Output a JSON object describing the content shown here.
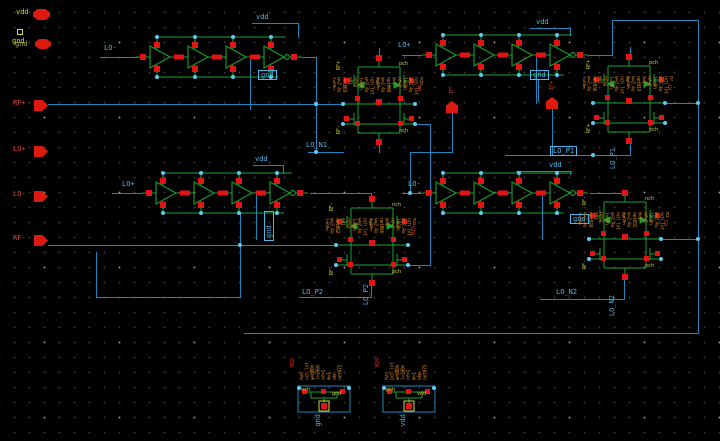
{
  "colors": {
    "wire": "#1b87bd",
    "net_label": "#4ab6e8",
    "device_green": "#17a22e",
    "terminal_red": "#e31414",
    "junction_cyan": "#5fc9f2",
    "annotation_orange": "#cd7d1f",
    "pin_label_yellow": "#d6d63e",
    "port_red": "#dd1a10"
  },
  "ports": {
    "vdd": "vdd",
    "gnd1": "gnd",
    "gnd2": "gnd",
    "rfp": "RF+",
    "lop": "LO+",
    "lon": "LO-",
    "rfm": "RF-",
    "ifm": "IF-",
    "ifp": "IF+"
  },
  "chains": [
    {
      "in": "LO-",
      "vdd": "vdd",
      "gnd": "gnd"
    },
    {
      "in": "LO+",
      "vdd": "vdd",
      "gnd": "gnd"
    },
    {
      "in": "LO+",
      "vdd": "vdd",
      "gnd": "gnd"
    },
    {
      "in": "LO-",
      "vdd": "vdd",
      "gnd": "gnd"
    }
  ],
  "nets": {
    "n1": "LO_N1",
    "p1": "LO_P1",
    "p2": "LO_P2",
    "n2": "LO_N2"
  },
  "stacks": [
    {
      "label": "LO_N1",
      "tag_m": "M4",
      "tags": {
        "a": "RF+",
        "b": "pch",
        "c": "RF-",
        "d": "nch"
      },
      "ann1": "M11\nnch_lvt\nw=2.4u\nl=60n\nnf=2\nm=1\nnet059\nw=2.4u\nl=60n\nnf=2",
      "ann2": "M10\nnch_lvt\nw=2.4u\nl=60n\nnf=2\nm=1\nnet048\nw=2.4u\nl=60n"
    },
    {
      "label": "LO_P1",
      "tag_m": "M7",
      "tags": {
        "a": "RF+",
        "b": "pch",
        "c": "RF+",
        "d": "nch"
      },
      "ann1": "M6\nnch_lvt\nw=2.4u\nl=60n\nnf=2\nm=1\nnet036\nw=2.4u\nl=60n\nnf=2",
      "ann2": "M7\nnch_lvt\nw=2.4u\nl=60n\nnf=2\nm=1\nnet019\nw=2.4u\nl=60n"
    },
    {
      "label": "LO_P2",
      "tag_m": "M15",
      "tags": {
        "a": "RF-",
        "b": "nch",
        "c": "RF-",
        "d": "pch"
      },
      "ann1": "M14\nnch_lvt\nw=2.4u\nl=60n\nnf=2\nm=1\nnet062\nw=2.4u\nl=60n\nnf=2",
      "ann2": "M15\nnch_lvt\nw=2.4u\nl=60n\nnf=2\nm=1\nnet066\nw=2.4u\nl=60n"
    },
    {
      "label": "LO_N2",
      "tag_m": "M3",
      "tags": {
        "a": "RF-",
        "b": "nch",
        "c": "RF-",
        "d": "nch"
      },
      "ann1": "M2\nnch_lvt\nw=2.4u\nl=60n\nnf=2\nm=1\nnet028\nw=2.4u\nl=60n\nnf=2",
      "ann2": "M3\nnch_lvt\nw=2.4u\nl=60n\nnf=2\nm=1\nnet031\nw=2.4u\nl=60n"
    }
  ],
  "dummies": [
    {
      "rail": "gnd",
      "tag_m": "M28",
      "tag_a": "nch",
      "tag_b": "gnd",
      "ann": "M28\nnch_lvt\nw=800n\nl=100n\nnf=1\nm=1\nvbn\nnet072"
    },
    {
      "rail": "vdd",
      "tag_m": "M29",
      "tag_a": "pch",
      "tag_b": "vdd",
      "ann": "M29\npch_lvt\nw=800n\nl=100n\nnf=1\nm=1\nvbp\nnet075"
    }
  ]
}
